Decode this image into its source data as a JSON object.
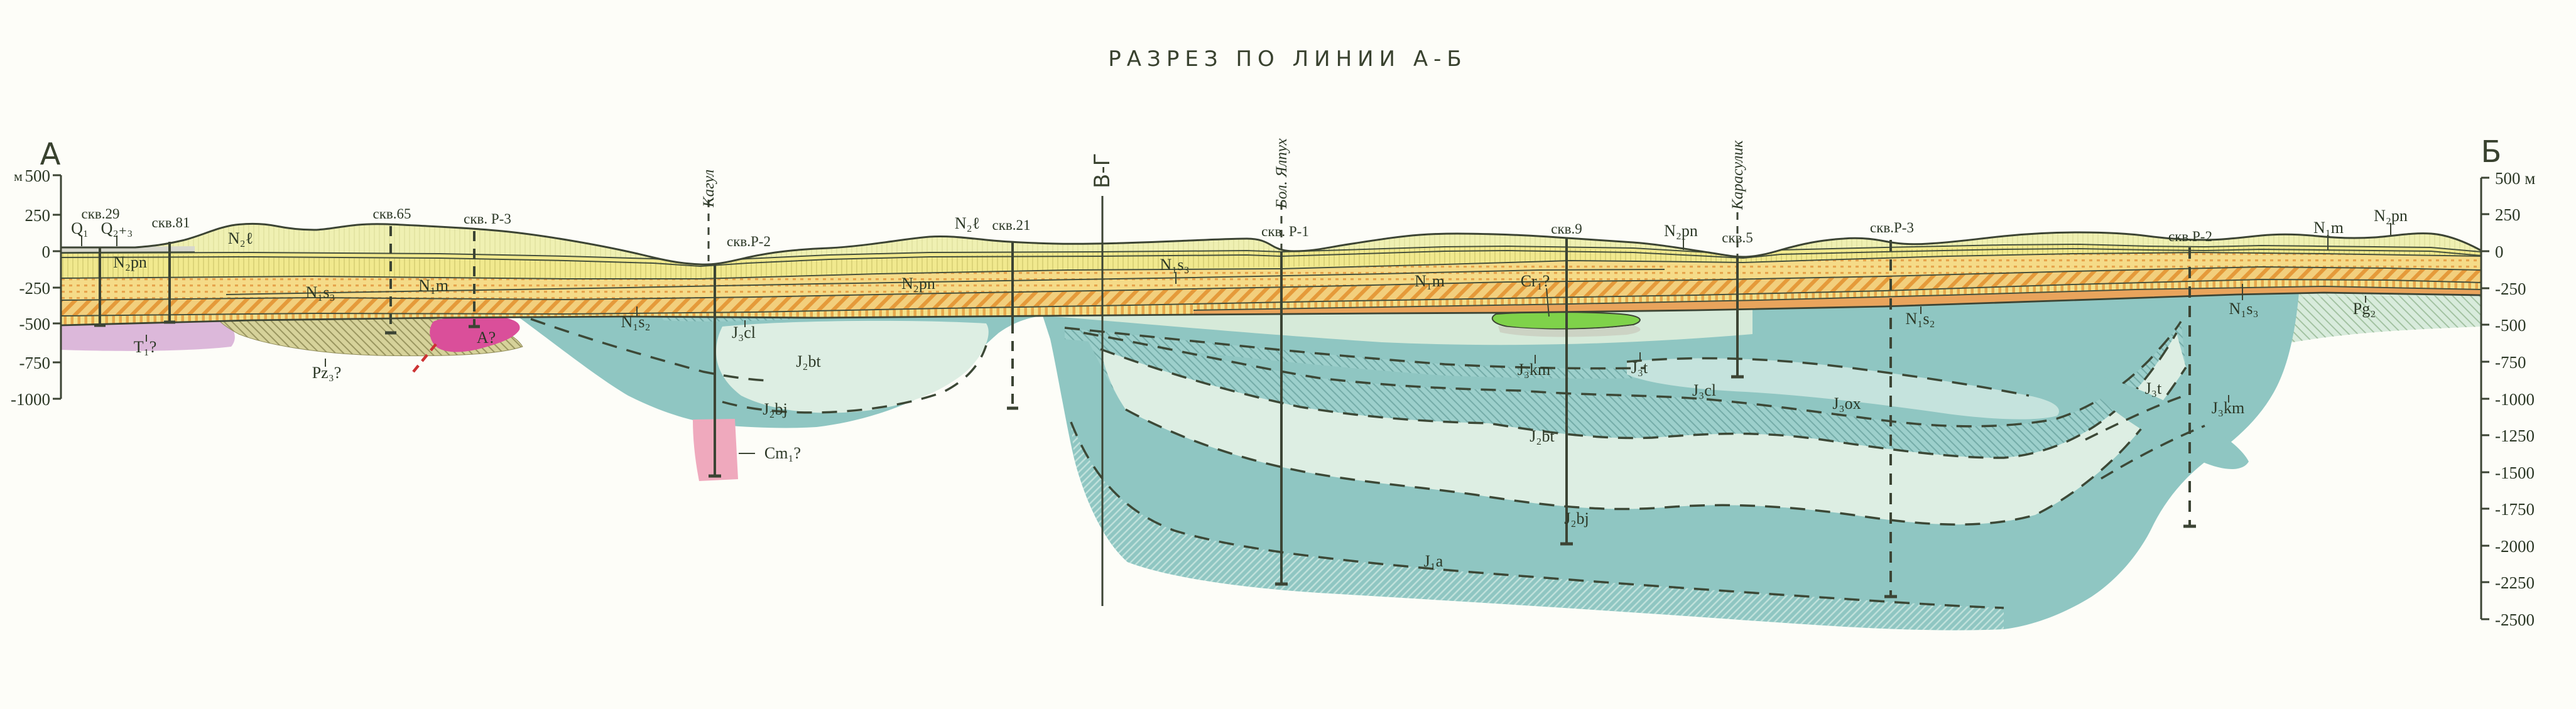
{
  "title": "РАЗРЕЗ ПО ЛИНИИ А-Б",
  "endpoints": {
    "left": "А",
    "right": "Б"
  },
  "axis_left": {
    "unit": "м",
    "ticks": [
      "500",
      "250",
      "0",
      "-250",
      "-500",
      "-750",
      "-1000"
    ]
  },
  "axis_right": {
    "ticks": [
      "500 м",
      "250",
      "0",
      "-250",
      "-500",
      "-750",
      "-1000",
      "-1250",
      "-1500",
      "-1750",
      "-2000",
      "-2250",
      "-2500"
    ]
  },
  "section_line": "В-Г",
  "rivers": {
    "kagul": "Кагул",
    "yalpukh": "Бол. Ялпух",
    "karasulik": "Карасулик"
  },
  "boreholes": {
    "b29": "скв.29",
    "b81": "скв.81",
    "b65": "скв.65",
    "bR3a": "скв. Р-3",
    "bR2a": "скв.Р-2",
    "b21": "скв.21",
    "bR1": "скв. Р-1",
    "b9": "скв.9",
    "b5": "скв.5",
    "bR3b": "скв.Р-3",
    "bR2b": "скв.Р-2"
  },
  "strata": {
    "q1": "Q₁",
    "q23": "Q₂₊₃",
    "n2l": "N₂ℓ",
    "n2pn": "N₂pn",
    "n1s3": "N₁s₃",
    "n1s2": "N₁s₂",
    "n1m": "N₁m",
    "cr1": "Cr₁?",
    "pg2": "Pg₂",
    "j3t": "J₃t",
    "j3km": "J₃km",
    "j3ox": "J₃ox",
    "j3cl": "J₃cl",
    "j2bt": "J₂bt",
    "j2bj": "J₂bj",
    "j1a": "J₁a",
    "t1": "T₁?",
    "pz3": "Pz₃?",
    "arch": "А?",
    "cm1": "Cm₁?"
  },
  "colors": {
    "paper": "#fdfdf8",
    "line": "#3c4434",
    "neogene_base": "#f2e38d",
    "n2l": "#eff0b2",
    "n2pn": "#f1e98e",
    "teal": "#8fc6c2",
    "pale_bt": "#ddeee3",
    "j3t_pale": "#d6ead9",
    "j3ox": "#c5e3dd",
    "green_cr1": "#7fd24a",
    "pink_t1": "#dcb8da",
    "magenta_a": "#da4f9a",
    "pink_cm1": "#efa9bd",
    "khaki_pz3": "#d6d29a"
  }
}
